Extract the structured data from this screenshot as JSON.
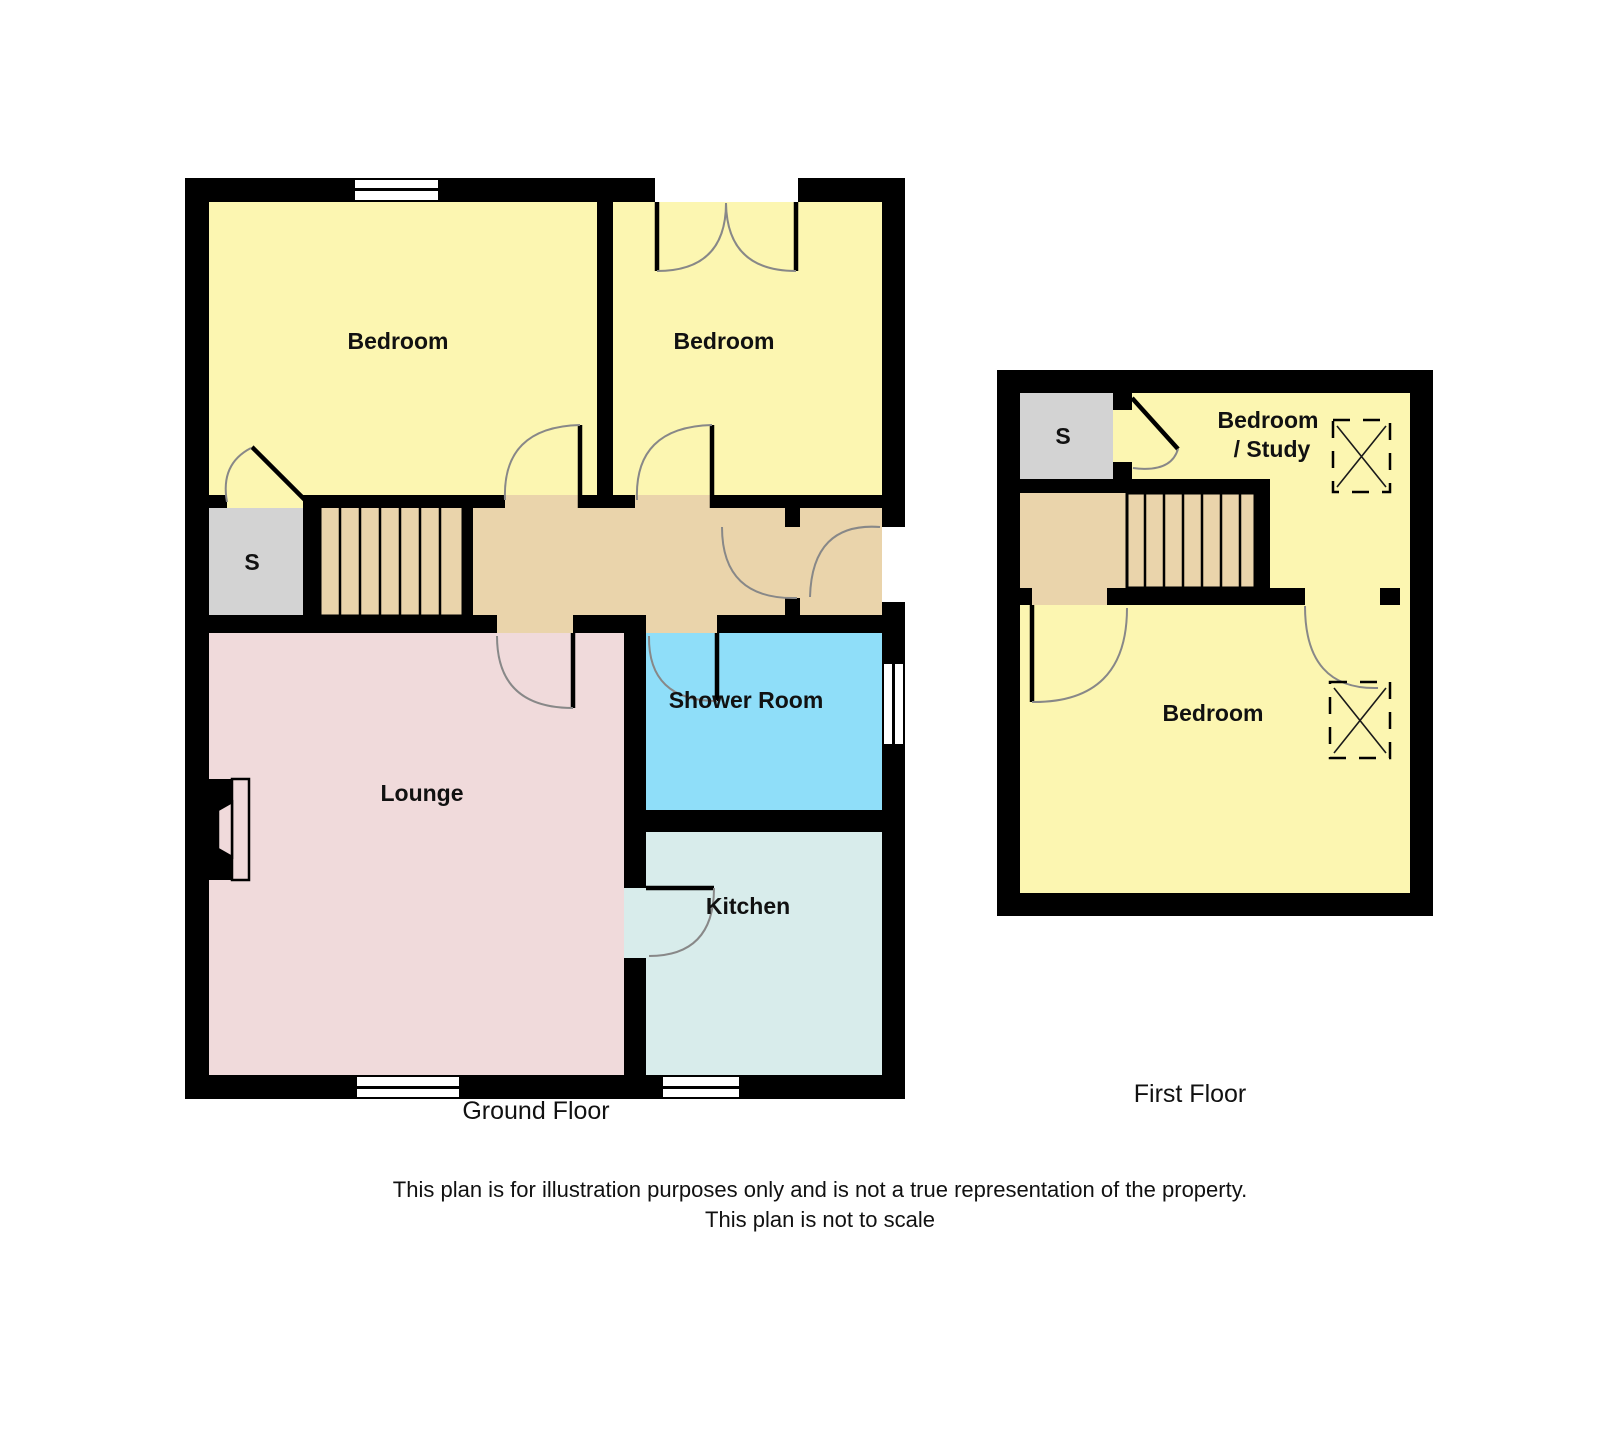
{
  "ground_floor": {
    "caption": "Ground Floor",
    "rooms": {
      "bedroom_left": "Bedroom",
      "bedroom_right": "Bedroom",
      "storage": "S",
      "lounge": "Lounge",
      "shower_room": "Shower Room",
      "kitchen": "Kitchen"
    }
  },
  "first_floor": {
    "caption": "First Floor",
    "rooms": {
      "storage": "S",
      "bedroom_study_line1": "Bedroom",
      "bedroom_study_line2": "/ Study",
      "bedroom": "Bedroom"
    }
  },
  "disclaimer": {
    "line1": "This plan is for illustration purposes only and is not a true representation of the property.",
    "line2": "This plan is not to scale"
  },
  "colors": {
    "room-yellow": "#FCF6B1",
    "hall-tan": "#EAD4AB",
    "lounge-pink": "#F0DADB",
    "shower-blue": "#8FDEF9",
    "kitchen-teal": "#D8ECEB",
    "storage-gray": "#D3D3D3",
    "wall-black": "#000000",
    "door-arc": "#888888",
    "text": "#111111"
  }
}
